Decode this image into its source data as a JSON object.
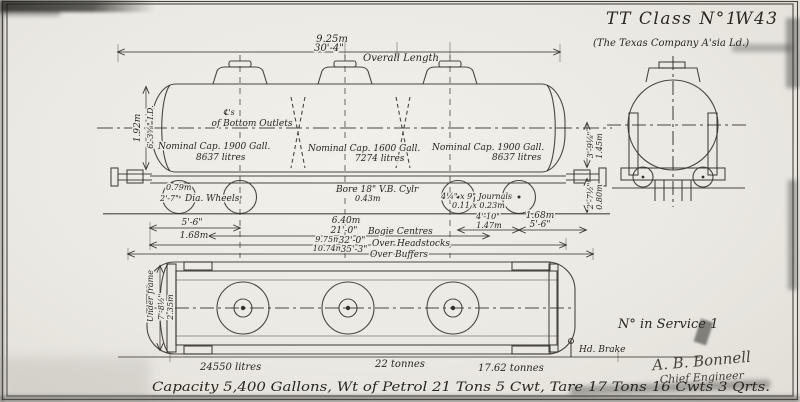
{
  "header": {
    "title": "TT Class N°1",
    "drawing_no": "W43",
    "subtitle": "(The Texas Company A'sia Ld.)"
  },
  "elevation": {
    "overall_m": "9.25m",
    "overall_ft": "30'-4\"",
    "overall_label": "Overall Length",
    "id_m": "1.92m",
    "id_ft": "6'-3⅝\" I.D.",
    "outlet_cl": "℄'s",
    "outlet_label": "of Bottom Outlets",
    "caps": [
      {
        "name": "Nominal Cap. 1900 Gall.",
        "litres": "8637 litres"
      },
      {
        "name": "Nominal Cap. 1600 Gall.",
        "litres": "7274 litres"
      },
      {
        "name": "Nominal Cap. 1900 Gall.",
        "litres": "8637 litres"
      }
    ],
    "wheel_m": "0.79m",
    "wheel_ft": "2'-7\"",
    "wheel_label": "Dia. Wheels",
    "cylinder": "Bore 18\" V.B. Cylr",
    "cylinder_m": "0.43m",
    "journals": "4¼\" x 9\" Journals",
    "journals_m": "0.11 x 0.23m",
    "height_ft": "3'-9⅛\"",
    "height_m": "1.45m",
    "buffer_ft": "2'-7½\"",
    "buffer_m": "0.80m",
    "wb_left_ft": "5'-6\"",
    "wb_left_m": "1.68m",
    "bogie_m": "6.40m",
    "bogie_ft": "21'-0\"",
    "bogie_label": "Bogie Centres",
    "headstocks_m": "9.75m",
    "headstocks_ft": "32'-0\"",
    "headstocks_label": "Over Headstocks",
    "buffers_m": "10.74m",
    "buffers_ft": "35'-3\"",
    "buffers_label": "Over Buffers",
    "right_ft": "4'-10\"",
    "right_m": "1.47m",
    "wb_right_m": "1.68m",
    "wb_right_ft": "5'-6\""
  },
  "plan": {
    "width_label": "Under frame",
    "width_ft": "7'-8½\"",
    "width_m": "2.35m",
    "litres": "24550 litres",
    "tonnes_mid": "22 tonnes",
    "tonnes_tare": "17.62 tonnes",
    "hand_brake": "Hd. Brake"
  },
  "footer": {
    "in_service": "N° in Service 1",
    "signature": "A. B. Bonnell",
    "signature_title": "Chief Engineer",
    "caption": "Capacity 5,400 Gallons,   Wt of Petrol 21 Tons 5 Cwt,   Tare 17 Tons 16 Cwts 3 Qrts."
  }
}
